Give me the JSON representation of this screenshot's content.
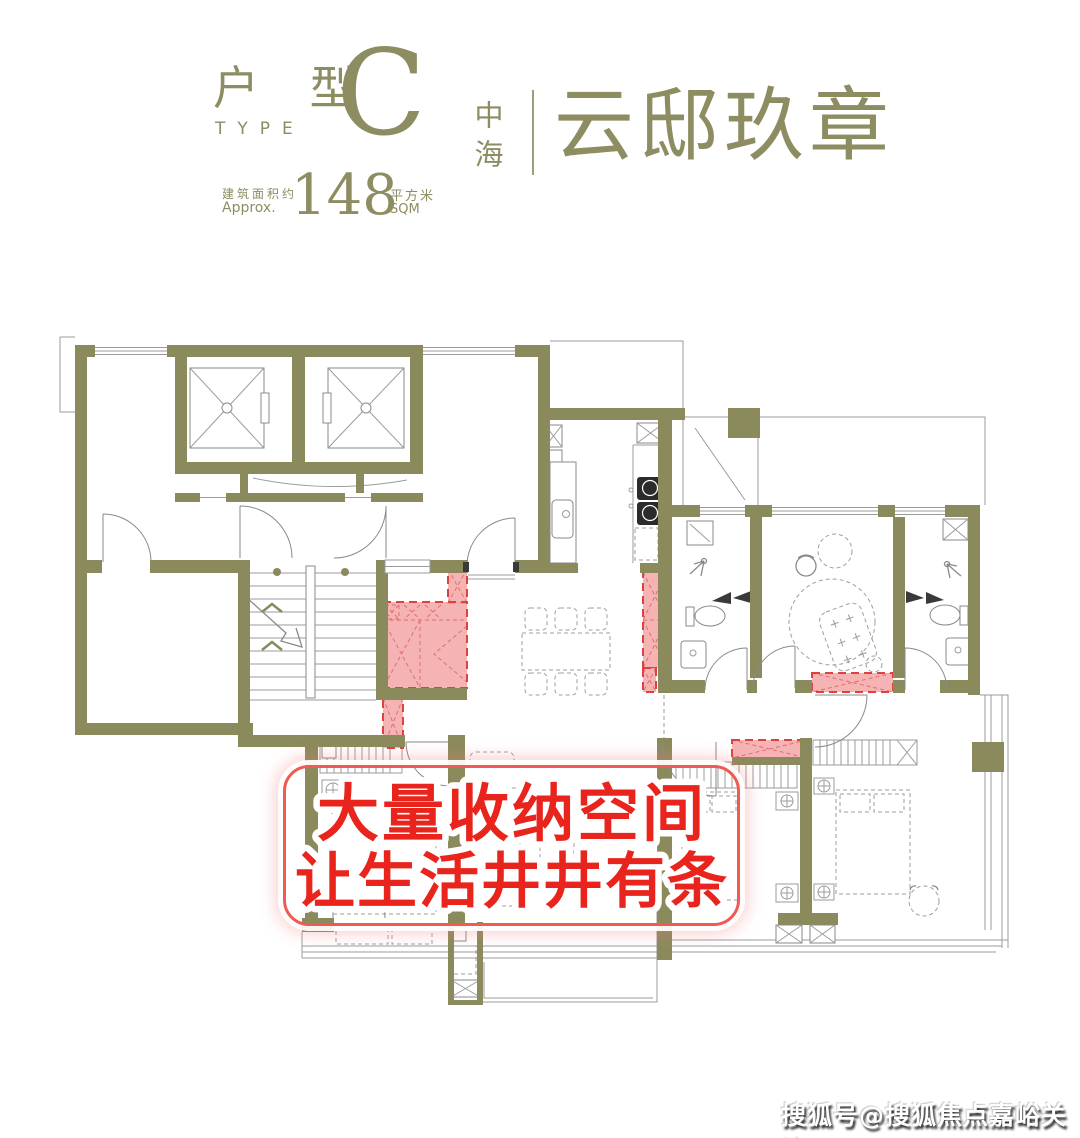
{
  "header": {
    "type_label_cn": "户 型",
    "type_label_en": "TYPE",
    "type_letter": "C",
    "area_label_cn": "建筑面积约",
    "area_label_en": "Approx.",
    "area_value": "148",
    "area_unit_cn": "平方米",
    "area_unit_en": "SQM"
  },
  "brand": {
    "developer": "中海",
    "project": "云邸玖章"
  },
  "annotation": {
    "line1": "大量收纳空间",
    "line2": "让生活井井有条"
  },
  "watermark": {
    "text": "搜狐号@搜狐焦点嘉峪关站"
  },
  "colors": {
    "wall_olive": "#8B8A5C",
    "text_olive": "#8E8C61",
    "highlight_fill": "#F5A6A6",
    "highlight_border": "#E0413F",
    "annotation_red": "#E8241D",
    "annotation_border": "#F05A52",
    "watermark_text": "#FFFFFF"
  }
}
